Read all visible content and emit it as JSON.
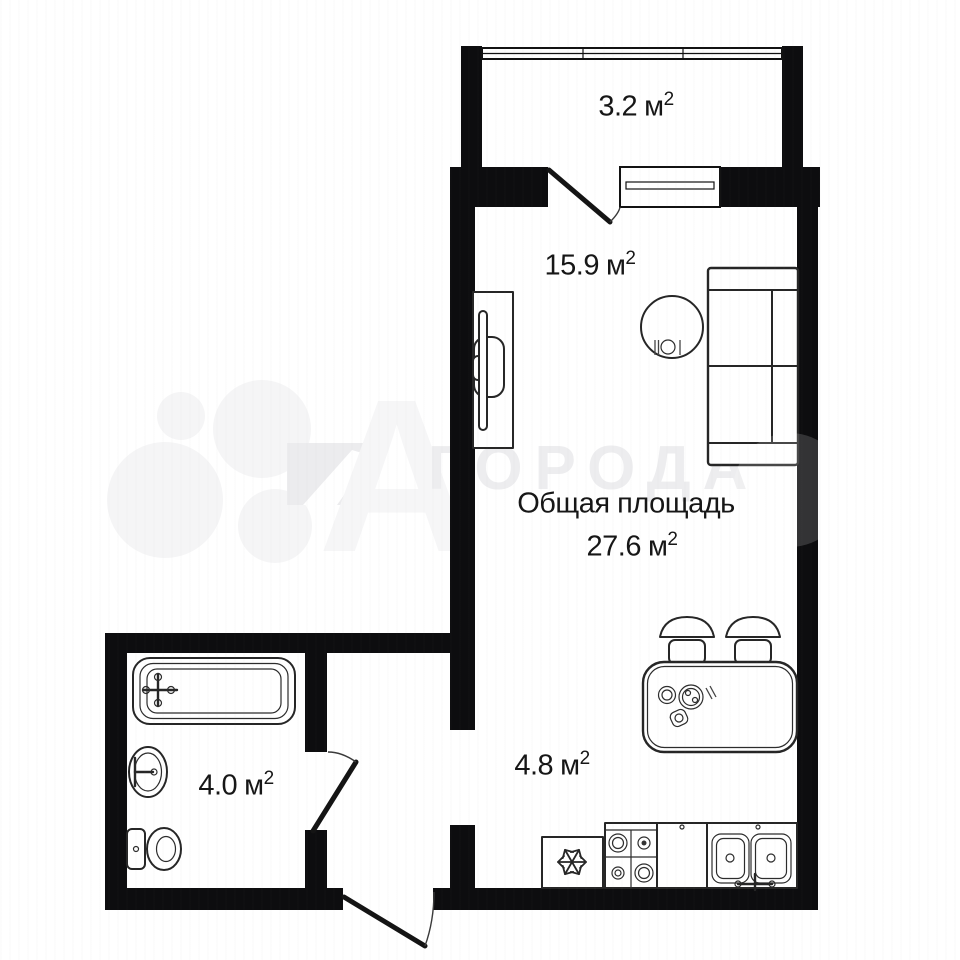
{
  "plan": {
    "type": "apartment-floor-plan",
    "total_area_label": "Общая площадь",
    "total_area_value": "27.6",
    "area_unit": "м",
    "area_sup": "2",
    "rooms": [
      {
        "id": "balcony",
        "area": "3.2"
      },
      {
        "id": "living-room",
        "area": "15.9"
      },
      {
        "id": "kitchen",
        "area": "4.8"
      },
      {
        "id": "bathroom",
        "area": "4.0"
      }
    ],
    "icons": [
      "snowflake-icon",
      "place-setting-icon"
    ],
    "colors": {
      "wall": "#0d0d0f",
      "furniture_line": "#262626",
      "text": "#161616",
      "watermark": "#ededef"
    }
  },
  "watermark": {
    "brand_text": "ГОРОДА",
    "big_letter": "А"
  }
}
